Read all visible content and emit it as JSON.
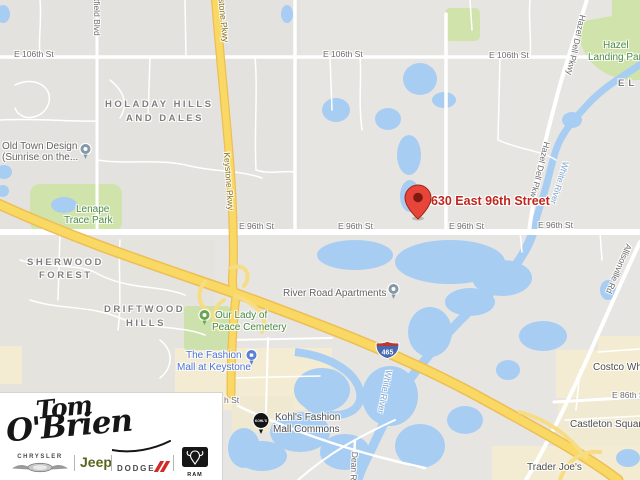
{
  "map": {
    "marker": {
      "label": "4630 East 96th Street"
    },
    "streets": {
      "e106_1": "E 106th St",
      "e106_2": "E 106th St",
      "e106_3": "E 106th St",
      "e96_1": "E 96th St",
      "e96_2": "E 96th St",
      "e96_3": "E 96th St",
      "e96_4": "E 96th St",
      "e86": "E 86th St",
      "st_fragment": "h St",
      "westfield": "Westfield Blvd",
      "keystone_1": "Keystone Pkwy",
      "keystone_2": "Keystone Pkwy",
      "hazel_dell_1": "Hazel Dell Pkwy",
      "hazel_dell_2": "Hazel Dell Pkwy",
      "allisonville": "Allisonville Rd",
      "dean": "Dean Rd"
    },
    "water_labels": {
      "white_river_1": "White River",
      "white_river_2": "White River"
    },
    "neighborhoods": {
      "holaday_1": "HOLADAY HILLS",
      "holaday_2": "AND DALES",
      "sherwood_1": "SHERWOOD",
      "sherwood_2": "FOREST",
      "driftwood_1": "DRIFTWOOD",
      "driftwood_2": "HILLS",
      "el": "EL"
    },
    "pois": {
      "old_town_1": "Old Town Design",
      "old_town_2": "(Sunrise on the...",
      "lenape_1": "Lenape",
      "lenape_2": "Trace Park",
      "hazel_landing_1": "Hazel",
      "hazel_landing_2": "Landing Park",
      "river_road": "River Road Apartments",
      "cemetery_1": "Our Lady of",
      "cemetery_2": "Peace Cemetery",
      "fashion_1": "The Fashion",
      "fashion_2": "Mall at Keystone",
      "kohls_1": "Kohl's Fashion",
      "kohls_2": "Mall Commons",
      "kohls_icon": "KOHL'S",
      "costco": "Costco Wholesale",
      "castleton": "Castleton Square",
      "trader": "Trader Joe's"
    },
    "shield": {
      "route": "465"
    },
    "colors": {
      "land": "#e7e5e1",
      "water": "#a8cdf3",
      "park": "#cfe3ab",
      "commercial": "#f3ecd3",
      "highway": "#f9d964",
      "highway_casing": "#edbe55",
      "marker_red": "#e8453a",
      "marker_label_red": "#c0261c",
      "shield_blue": "#4868b0",
      "shield_red": "#b6392f"
    }
  },
  "logo": {
    "dealer_first": "Tom",
    "dealer_last": "O'Brien",
    "brands": {
      "chrysler": "CHRYSLER",
      "jeep": "Jeep",
      "dodge": "DODGE",
      "ram": "RAM"
    }
  }
}
